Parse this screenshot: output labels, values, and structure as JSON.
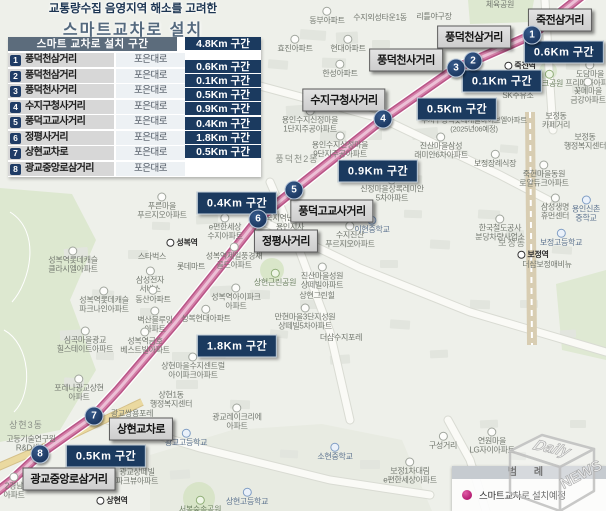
{
  "title": {
    "line1": "교통량수집 음영지역 해소를 고려한",
    "line2": "스마트교차로  설치"
  },
  "table": {
    "header": {
      "label": "스마트 교차로 설치 구간",
      "total": "4.8Km 구간"
    },
    "rows": [
      {
        "no": "1",
        "name": "풍덕천삼거리",
        "road": "포은대로"
      },
      {
        "no": "2",
        "name": "풍덕천삼거리",
        "road": "포은대로"
      },
      {
        "no": "3",
        "name": "풍덕천사거리",
        "road": "포은대로"
      },
      {
        "no": "4",
        "name": "수지구청사거리",
        "road": "포은대로"
      },
      {
        "no": "5",
        "name": "풍덕고교사거리",
        "road": "포은대로"
      },
      {
        "no": "6",
        "name": "정평사거리",
        "road": "포은대로"
      },
      {
        "no": "7",
        "name": "상현교차로",
        "road": "포은대로"
      },
      {
        "no": "8",
        "name": "광교중앙로삼거리",
        "road": "포은대로"
      }
    ],
    "segments": [
      "0.6Km 구간",
      "0.1Km 구간",
      "0.5Km 구간",
      "0.9Km 구간",
      "0.4Km 구간",
      "1.8Km 구간",
      "0.5Km 구간"
    ]
  },
  "map": {
    "route_points": "584,-6 532,35 473,61 456,68 383,119 294,190 258,219 232,252 176,322 118,390 94,416 40,454 12,480 -6,494",
    "markers": [
      {
        "no": "1",
        "x": 532,
        "y": 35
      },
      {
        "no": "2",
        "x": 473,
        "y": 61
      },
      {
        "no": "3",
        "x": 456,
        "y": 68
      },
      {
        "no": "4",
        "x": 383,
        "y": 119
      },
      {
        "no": "5",
        "x": 294,
        "y": 190
      },
      {
        "no": "6",
        "x": 258,
        "y": 219
      },
      {
        "no": "7",
        "x": 94,
        "y": 416
      },
      {
        "no": "8",
        "x": 40,
        "y": 454
      }
    ],
    "intersections": [
      {
        "text": "죽전삼거리",
        "x": 560,
        "y": 20
      },
      {
        "text": "풍덕천삼거리",
        "x": 474,
        "y": 37
      },
      {
        "text": "풍덕천사거리",
        "x": 406,
        "y": 60
      },
      {
        "text": "수지구청사거리",
        "x": 344,
        "y": 100
      },
      {
        "text": "풍덕고교사거리",
        "x": 332,
        "y": 211
      },
      {
        "text": "정평사거리",
        "x": 286,
        "y": 241
      },
      {
        "text": "상현교차로",
        "x": 141,
        "y": 429
      },
      {
        "text": "광교중앙로삼거리",
        "x": 69,
        "y": 479
      }
    ],
    "distances": [
      {
        "text": "0.6Km 구간",
        "x": 564,
        "y": 52
      },
      {
        "text": "0.1Km 구간",
        "x": 502,
        "y": 81
      },
      {
        "text": "0.5Km 구간",
        "x": 457,
        "y": 109
      },
      {
        "text": "0.9Km 구간",
        "x": 378,
        "y": 171
      },
      {
        "text": "0.4Km 구간",
        "x": 237,
        "y": 203
      },
      {
        "text": "1.8Km 구간",
        "x": 237,
        "y": 346
      },
      {
        "text": "0.5Km 구간",
        "x": 106,
        "y": 456
      }
    ],
    "pois": [
      {
        "x": 500,
        "y": 5,
        "t": "t",
        "lines": [
          "체육공원"
        ]
      },
      {
        "x": 434,
        "y": 17,
        "t": "t",
        "lines": [
          "리틀야구장"
        ]
      },
      {
        "x": 327,
        "y": 16,
        "t": "a",
        "lines": [
          "동부아파트"
        ]
      },
      {
        "x": 380,
        "y": 18,
        "t": "t",
        "lines": [
          "수지외성타운1동"
        ]
      },
      {
        "x": 295,
        "y": 44,
        "t": "a",
        "lines": [
          "효진아파트"
        ]
      },
      {
        "x": 348,
        "y": 44,
        "t": "a",
        "lines": [
          "현대아파트"
        ]
      },
      {
        "x": 340,
        "y": 69,
        "t": "a",
        "lines": [
          "한성아파트"
        ]
      },
      {
        "x": 520,
        "y": 66,
        "t": "st",
        "lines": [
          "죽전역"
        ]
      },
      {
        "x": 549,
        "y": 79,
        "t": "p",
        "lines": [
          "파크공원"
        ]
      },
      {
        "x": 590,
        "y": 74,
        "t": "a",
        "lines": [
          "도담마을",
          "프리메라아파트"
        ]
      },
      {
        "x": 588,
        "y": 91,
        "t": "a",
        "lines": [
          "꽃메마을",
          "금강아파트"
        ]
      },
      {
        "x": 518,
        "y": 96,
        "t": "t",
        "lines": [
          "SK주유소"
        ]
      },
      {
        "x": 556,
        "y": 121,
        "t": "t",
        "lines": [
          "보정동",
          "카페거리"
        ]
      },
      {
        "x": 585,
        "y": 142,
        "t": "t",
        "lines": [
          "보정동",
          "행정복지센터"
        ]
      },
      {
        "x": 495,
        "y": 159,
        "t": "a",
        "lines": [
          "보정장례식장"
        ]
      },
      {
        "x": 544,
        "y": 174,
        "t": "a",
        "lines": [
          "죽현마을동원",
          "로얄듀크아파트"
        ]
      },
      {
        "x": 555,
        "y": 207,
        "t": "a",
        "lines": [
          "삼성생명",
          "휴먼센터"
        ]
      },
      {
        "x": 586,
        "y": 209,
        "t": "s",
        "lines": [
          "용인신촌",
          "중학교"
        ]
      },
      {
        "x": 500,
        "y": 228,
        "t": "a",
        "lines": [
          "한국철도공사",
          "분당차량사업소"
        ]
      },
      {
        "x": 512,
        "y": 243,
        "t": "ar",
        "lines": [
          "보정동"
        ]
      },
      {
        "x": 561,
        "y": 238,
        "t": "s",
        "lines": [
          "보정고등학교"
        ]
      },
      {
        "x": 533,
        "y": 255,
        "t": "st",
        "lines": [
          "보정역"
        ]
      },
      {
        "x": 547,
        "y": 265,
        "t": "t",
        "lines": [
          "더샵보정애비뉴"
        ]
      },
      {
        "x": 310,
        "y": 120,
        "t": "a",
        "lines": [
          "용인수지신정마을",
          "1단지주공아파트"
        ]
      },
      {
        "x": 340,
        "y": 145,
        "t": "a",
        "lines": [
          "용인수지신정마을",
          "9단지주공아파트"
        ]
      },
      {
        "x": 441,
        "y": 146,
        "t": "a",
        "lines": [
          "진산마을삼성",
          "래미안6차아파트"
        ]
      },
      {
        "x": 474,
        "y": 125,
        "t": "tl",
        "lines": [
          "수지구청역롯데캐슬하이브엘아파트",
          "(2025년06예정)"
        ]
      },
      {
        "x": 297,
        "y": 159,
        "t": "ar",
        "lines": [
          "풍덕천2동"
        ]
      },
      {
        "x": 392,
        "y": 189,
        "t": "a",
        "lines": [
          "신정마을상록레미안",
          "5차아파트"
        ]
      },
      {
        "x": 372,
        "y": 225,
        "t": "s",
        "lines": [
          "이현중학교"
        ]
      },
      {
        "x": 350,
        "y": 235,
        "t": "a",
        "lines": [
          "수지진산",
          "푸르지오아파트"
        ]
      },
      {
        "x": 290,
        "y": 223,
        "t": "t",
        "lines": [
          "국지역난방공사",
          "용인지사"
        ]
      },
      {
        "x": 225,
        "y": 227,
        "t": "a",
        "lines": [
          "e편한세상",
          "수지아파트"
        ]
      },
      {
        "x": 162,
        "y": 206,
        "t": "a",
        "lines": [
          "푸른마을",
          "푸르지오아파트"
        ]
      },
      {
        "x": 182,
        "y": 243,
        "t": "st",
        "lines": [
          "성복역"
        ]
      },
      {
        "x": 152,
        "y": 257,
        "t": "t",
        "lines": [
          "스타벅스"
        ]
      },
      {
        "x": 191,
        "y": 267,
        "t": "t",
        "lines": [
          "롯데마트"
        ]
      },
      {
        "x": 150,
        "y": 280,
        "t": "a",
        "lines": [
          "삼성전자",
          "서비스"
        ]
      },
      {
        "x": 234,
        "y": 256,
        "t": "a",
        "lines": [
          "성복역제일풍경채",
          "골드아파트"
        ]
      },
      {
        "x": 275,
        "y": 278,
        "t": "p",
        "lines": [
          "상현근린공원"
        ]
      },
      {
        "x": 322,
        "y": 276,
        "t": "a",
        "lines": [
          "진산마을성원",
          "상떼빌아파트"
        ]
      },
      {
        "x": 317,
        "y": 296,
        "t": "t",
        "lines": [
          "상현그린힐"
        ]
      },
      {
        "x": 236,
        "y": 297,
        "t": "a",
        "lines": [
          "성복역아이파크",
          "아파트"
        ]
      },
      {
        "x": 206,
        "y": 314,
        "t": "a",
        "lines": [
          "성복현대아파트"
        ]
      },
      {
        "x": 305,
        "y": 317,
        "t": "a",
        "lines": [
          "만현마을3단지성원",
          "상떼빌5차아파트"
        ]
      },
      {
        "x": 341,
        "y": 338,
        "t": "t",
        "lines": [
          "더샵수지포레"
        ]
      },
      {
        "x": 155,
        "y": 320,
        "t": "a",
        "lines": [
          "벽산블루밍",
          "아파트"
        ]
      },
      {
        "x": 153,
        "y": 295,
        "t": "a",
        "lines": [
          "동산아파트"
        ]
      },
      {
        "x": 73,
        "y": 260,
        "t": "a",
        "lines": [
          "성복역롯데캐슬",
          "클라시엘아파트"
        ]
      },
      {
        "x": 104,
        "y": 300,
        "t": "a",
        "lines": [
          "성복역롯데캐슬",
          "파크나인아파트"
        ]
      },
      {
        "x": 85,
        "y": 340,
        "t": "a",
        "lines": [
          "심곡마을광교",
          "힐스테이트아파트"
        ]
      },
      {
        "x": 145,
        "y": 341,
        "t": "a",
        "lines": [
          "성복역금호",
          "베스트빌아파트"
        ]
      },
      {
        "x": 193,
        "y": 366,
        "t": "a",
        "lines": [
          "상현마을수지센트럴",
          "아이파크아파트"
        ]
      },
      {
        "x": 79,
        "y": 388,
        "t": "a",
        "lines": [
          "포레나광교상현",
          "아파트"
        ]
      },
      {
        "x": 171,
        "y": 400,
        "t": "t",
        "lines": [
          "상현1동",
          "행정복지센터"
        ]
      },
      {
        "x": 237,
        "y": 417,
        "t": "a",
        "lines": [
          "광교레이크리에",
          "아파트"
        ]
      },
      {
        "x": 26,
        "y": 425,
        "t": "ar",
        "lines": [
          "상현3동"
        ]
      },
      {
        "x": 31,
        "y": 444,
        "t": "t",
        "lines": [
          "고등기술연구원",
          "R&D센터"
        ]
      },
      {
        "x": 132,
        "y": 414,
        "t": "t",
        "lines": [
          "광교쌍용포레"
        ]
      },
      {
        "x": 186,
        "y": 438,
        "t": "s",
        "lines": [
          "광교고등학교"
        ]
      },
      {
        "x": 137,
        "y": 472,
        "t": "a",
        "lines": [
          "광교상떼빌",
          "파크뷰아파트"
        ]
      },
      {
        "x": 112,
        "y": 501,
        "t": "st",
        "lines": [
          "상현역"
        ]
      },
      {
        "x": 247,
        "y": 497,
        "t": "s",
        "lines": [
          "상현고등학교"
        ]
      },
      {
        "x": 335,
        "y": 452,
        "t": "s",
        "lines": [
          "소현중학교"
        ]
      },
      {
        "x": 410,
        "y": 471,
        "t": "a",
        "lines": [
          "보정1차대림",
          "e편한세상아파트"
        ]
      },
      {
        "x": 200,
        "y": 505,
        "t": "p",
        "lines": [
          "서봉숲속공원"
        ]
      },
      {
        "x": 492,
        "y": 441,
        "t": "a",
        "lines": [
          "연원마을",
          "LG자이아파트"
        ]
      },
      {
        "x": 443,
        "y": 441,
        "t": "a",
        "lines": [
          "구성거리"
        ]
      },
      {
        "x": 14,
        "y": 486,
        "t": "a",
        "lines": [
          "2경남",
          "아파트"
        ]
      }
    ]
  },
  "legend": {
    "title": "범 례",
    "item": "스마트교차로 설치예정",
    "dot_color": "#c0267d"
  },
  "watermark": {
    "top": "Daily",
    "side": "NEWS"
  },
  "colors": {
    "navy": "#1b3a5f",
    "header_gray": "#5c6c7c",
    "route_pink": "#c9659a",
    "map_bg": "#eef0ea"
  }
}
